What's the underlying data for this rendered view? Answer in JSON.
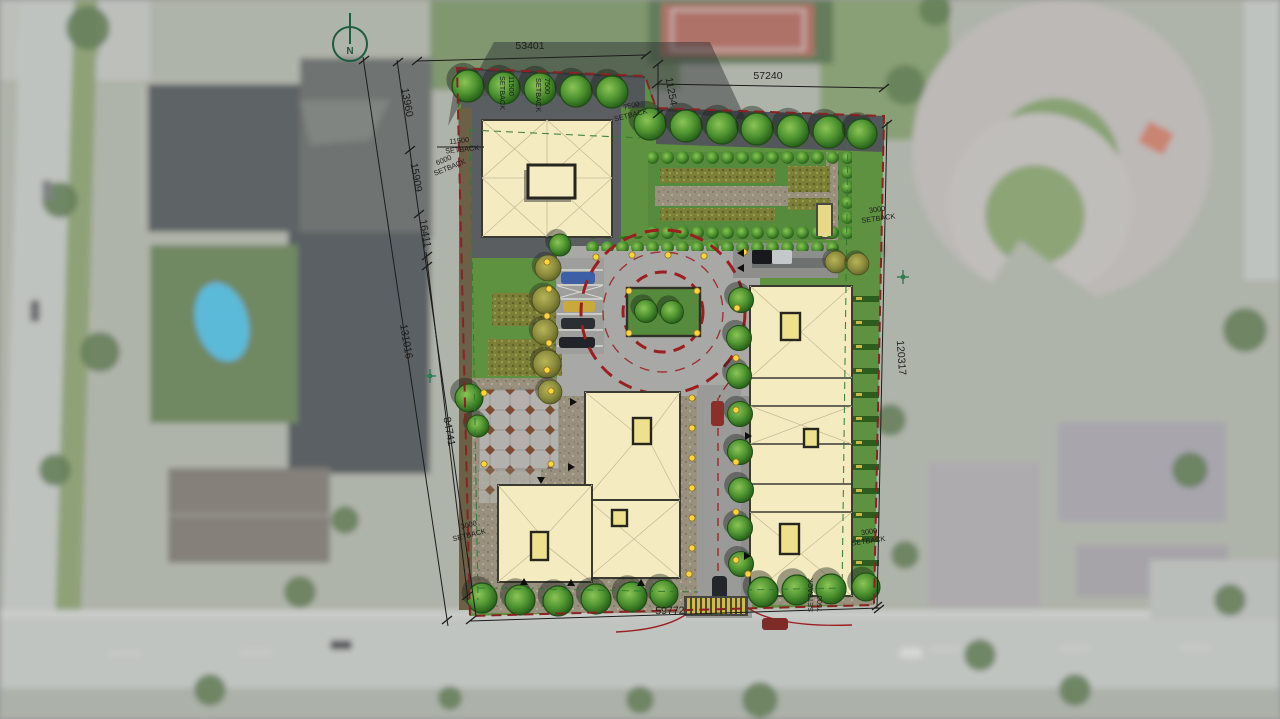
{
  "view": {
    "type": "architectural site plan rendered over aerial photo",
    "north_label": "N"
  },
  "dimensions": {
    "top_west": "53401",
    "top_east": "57240",
    "northeast_offset": "11254",
    "west_seg_1": "13960",
    "west_seg_2": "15909",
    "west_seg_3": "16411",
    "west_total": "131016",
    "west_inner": "84741",
    "east_total": "120317",
    "south_total": "59772"
  },
  "setbacks": {
    "word": "SETBACK",
    "front_upper": "11500",
    "front_lower": "6000",
    "north_gap": "7500",
    "north_row_a": "11500",
    "north_row_b": "7500",
    "east_upper": "3000",
    "east_lower": "3000",
    "south_west": "3000",
    "south_drive": "7500"
  },
  "colors": {
    "lawn": "#5e9140",
    "roof": "#f4ebc1",
    "roof_line": "#3a3a33",
    "skylight": "#efe08d",
    "paving": "#a8a9a6",
    "red_dash": "#9c1e20",
    "boundary": "#8a2222",
    "dim": "#1c1c1c",
    "light_dot": "#ffd43f",
    "north_arrow": "#1d5c3c"
  }
}
